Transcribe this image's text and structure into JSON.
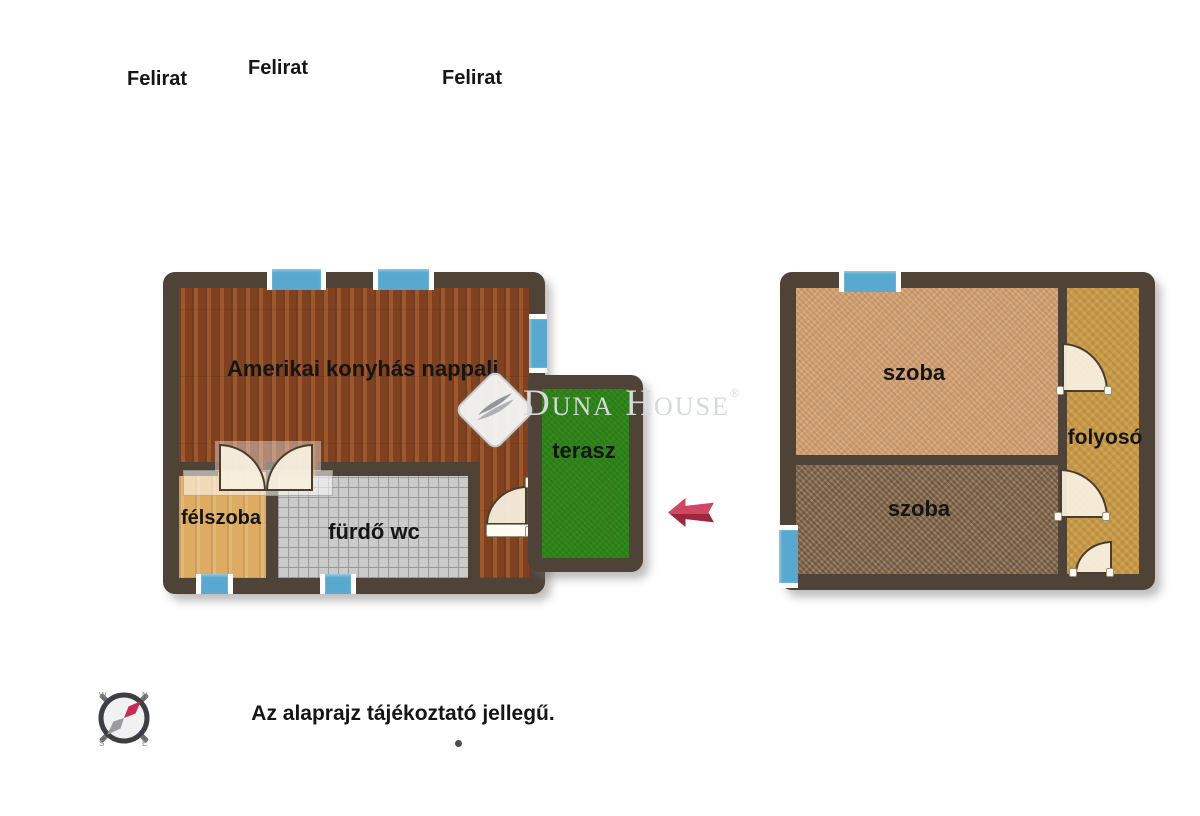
{
  "background": "#ffffff",
  "top_labels": {
    "label1": "Felirat",
    "label2": "Felirat",
    "label3": "Felirat"
  },
  "left_plan": {
    "rooms": {
      "living_room": {
        "label": "Amerikai konyhás nappali"
      },
      "half_room": {
        "label": "félszoba"
      },
      "bathroom": {
        "label": "fürdő wc"
      },
      "terrace": {
        "label": "terasz"
      }
    }
  },
  "right_plan": {
    "rooms": {
      "room_top": {
        "label": "szoba"
      },
      "room_bottom": {
        "label": "szoba"
      },
      "corridor": {
        "label": "folyosó"
      }
    }
  },
  "watermark": {
    "brand": "Duna House",
    "registered": "®"
  },
  "compass": {
    "north": "N",
    "east": "E",
    "south": "S",
    "west": "W"
  },
  "footer": {
    "disclaimer": "Az alaprajz tájékoztató jellegű."
  },
  "colors": {
    "wall": "#4f4236",
    "wood_floor": "#8d4a24",
    "half_room_floor": "#ddab61",
    "tile_floor": "#cbcbcb",
    "terrace_green": "#2f8519",
    "room_top_carpet": "#d2a173",
    "room_bottom_carpet": "#8a6f53",
    "corridor_floor": "#c89a49",
    "window_blue": "#58a8cf",
    "door_cream": "#f2e9d4",
    "arrow_red": "#c23552"
  }
}
